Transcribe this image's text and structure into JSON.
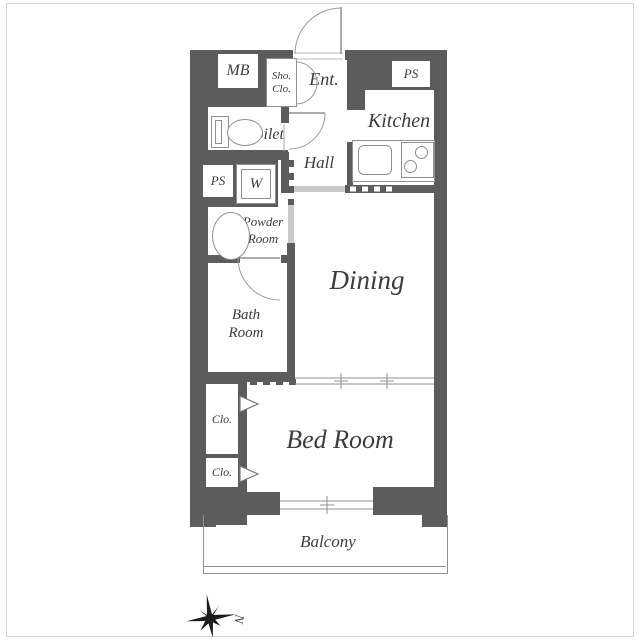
{
  "plan": {
    "title": "apartment-floor-plan",
    "rooms": {
      "mb": "MB",
      "sho_line1": "Sho.",
      "sho_line2": "Clo.",
      "ent": "Ent.",
      "ps_top": "PS",
      "toilet": "Toilet",
      "kitchen": "Kitchen",
      "hall": "Hall",
      "ps_left": "PS",
      "washer": "W",
      "powder_line1": "Powder",
      "powder_line2": "Room",
      "dining": "Dining",
      "bath_line1": "Bath",
      "bath_line2": "Room",
      "closet_upper": "Clo.",
      "closet_lower": "Clo.",
      "bedroom": "Bed Room",
      "balcony": "Balcony"
    },
    "compass": {
      "north_label": "N"
    },
    "colors": {
      "wall": "#5c5c5c",
      "thin_line": "#8f8f8f",
      "opening": "#c9c9c9",
      "text": "#3d3d3d",
      "background": "#ffffff",
      "page_frame": "#d4d4d4"
    }
  }
}
